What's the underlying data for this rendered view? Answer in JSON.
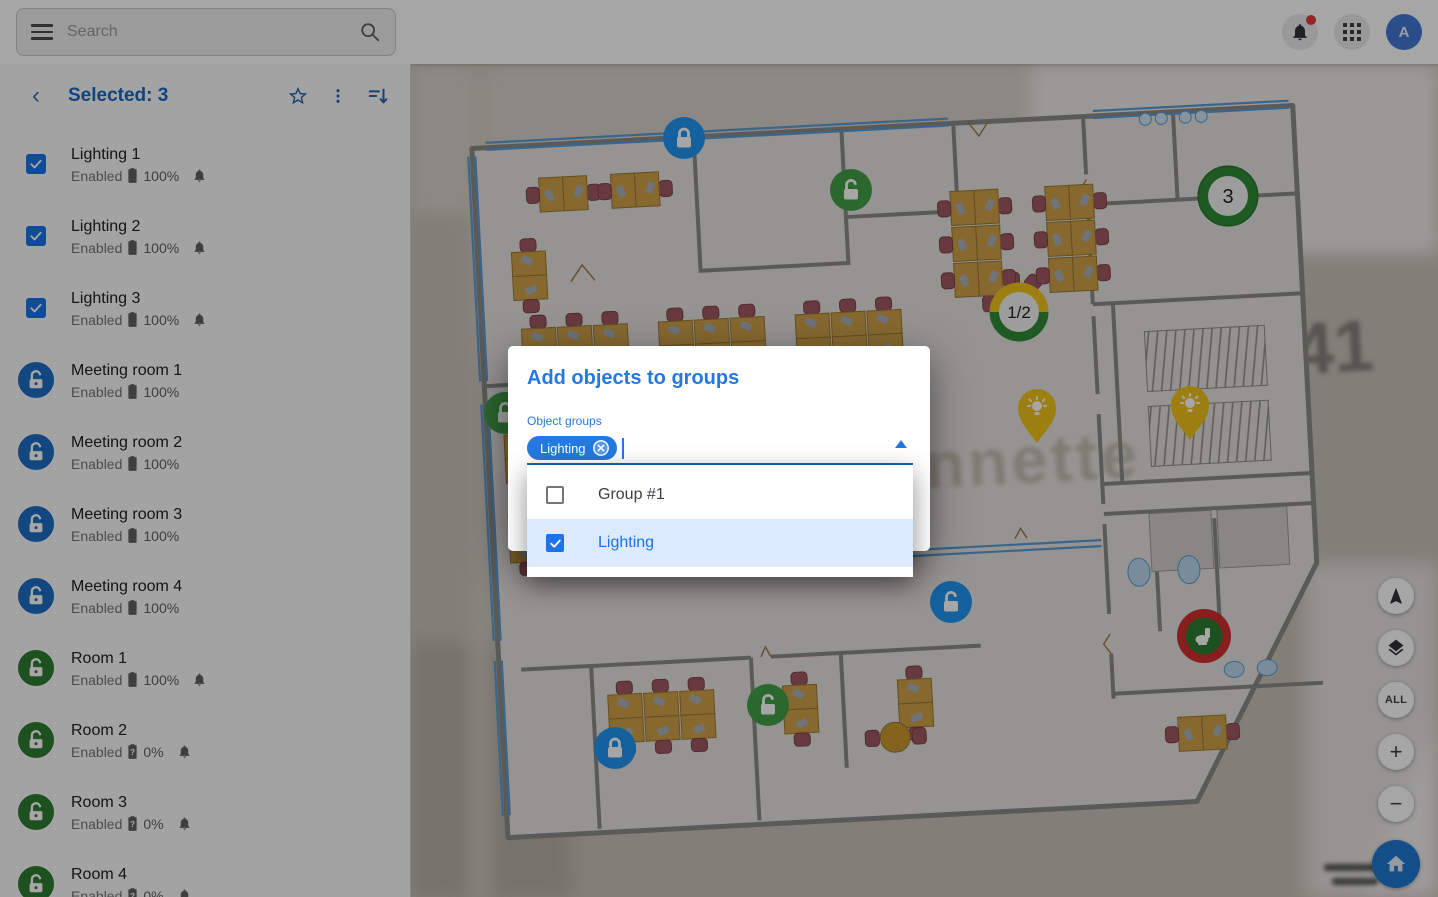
{
  "topbar": {
    "search_placeholder": "Search",
    "avatar_text": "A",
    "notification_dot": true
  },
  "sidebar": {
    "header": {
      "title": "Selected: 3"
    },
    "items": [
      {
        "name": "Lighting 1",
        "status": "Enabled",
        "battery": "100%",
        "battery_unknown": false,
        "bell": true,
        "icon": "checkbox"
      },
      {
        "name": "Lighting 2",
        "status": "Enabled",
        "battery": "100%",
        "battery_unknown": false,
        "bell": true,
        "icon": "checkbox"
      },
      {
        "name": "Lighting 3",
        "status": "Enabled",
        "battery": "100%",
        "battery_unknown": false,
        "bell": true,
        "icon": "checkbox"
      },
      {
        "name": "Meeting room 1",
        "status": "Enabled",
        "battery": "100%",
        "battery_unknown": false,
        "bell": false,
        "icon": "lock-blue"
      },
      {
        "name": "Meeting room 2",
        "status": "Enabled",
        "battery": "100%",
        "battery_unknown": false,
        "bell": false,
        "icon": "lock-blue"
      },
      {
        "name": "Meeting room 3",
        "status": "Enabled",
        "battery": "100%",
        "battery_unknown": false,
        "bell": false,
        "icon": "lock-blue"
      },
      {
        "name": "Meeting room 4",
        "status": "Enabled",
        "battery": "100%",
        "battery_unknown": false,
        "bell": false,
        "icon": "lock-blue"
      },
      {
        "name": "Room 1",
        "status": "Enabled",
        "battery": "100%",
        "battery_unknown": false,
        "bell": true,
        "icon": "lock-green"
      },
      {
        "name": "Room 2",
        "status": "Enabled",
        "battery": "0%",
        "battery_unknown": true,
        "bell": true,
        "icon": "lock-green"
      },
      {
        "name": "Room 3",
        "status": "Enabled",
        "battery": "0%",
        "battery_unknown": true,
        "bell": true,
        "icon": "lock-green"
      },
      {
        "name": "Room 4",
        "status": "Enabled",
        "battery": "0%",
        "battery_unknown": true,
        "bell": true,
        "icon": "lock-green"
      }
    ]
  },
  "modal": {
    "title": "Add objects to groups",
    "field_label": "Object groups",
    "chip": {
      "label": "Lighting"
    },
    "options": [
      {
        "label": "Group #1",
        "checked": false
      },
      {
        "label": "Lighting",
        "checked": true
      }
    ]
  },
  "map": {
    "badge_count": "3",
    "badge_ratio": "1/2",
    "watermark_text": "onnette",
    "watermark_number": "41"
  },
  "controls": {
    "all_label": "ALL",
    "zoom_in": "+",
    "zoom_out": "−"
  },
  "colors": {
    "accent": "#1a73e8",
    "selected_row": "#dbeafd",
    "marker_green": "#43a047",
    "marker_blue": "#2196f3",
    "marker_yellow": "#f0c419",
    "marker_red": "#d32f2f"
  }
}
